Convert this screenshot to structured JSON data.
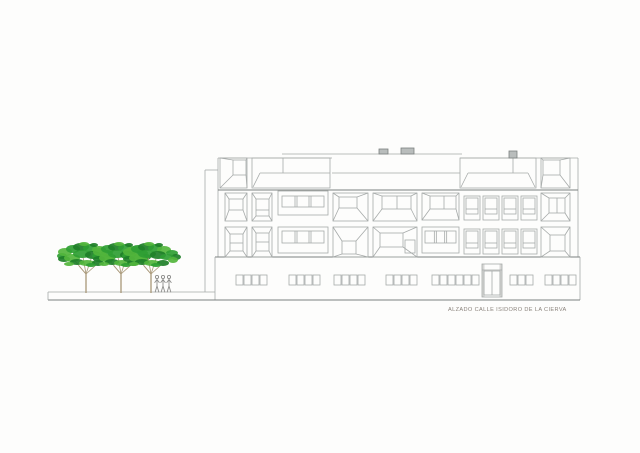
{
  "title_caption": "ALZADO CALLE ISIDORO DE LA CIERVA",
  "colors": {
    "background": "#fdfdfc",
    "line": "#a6aaa9",
    "line_dark": "#7c817f",
    "caption_text": "#8a827b",
    "vent_fill": "#b9bdbc",
    "jamb_fill": "#d8d8d6",
    "trunk": "#a89878",
    "person": "#8d8d8b",
    "greens": [
      "#2f9e33",
      "#53b53c",
      "#1e7f28"
    ]
  },
  "drawing": {
    "canvas": {
      "w": 640,
      "h": 453
    },
    "lines": [
      [
        218,
        158,
        218,
        257,
        "n"
      ],
      [
        578,
        158,
        578,
        257,
        "n"
      ],
      [
        218,
        158,
        332,
        158,
        "n"
      ],
      [
        460,
        158,
        578,
        158,
        "n"
      ],
      [
        218,
        190,
        578,
        190,
        "d"
      ],
      [
        215,
        257,
        580,
        257,
        "d"
      ],
      [
        215,
        257,
        215,
        300,
        "n"
      ],
      [
        580,
        257,
        580,
        300,
        "n"
      ],
      [
        48,
        300,
        580,
        300,
        "d"
      ],
      [
        48,
        292,
        215,
        292,
        "n"
      ],
      [
        48,
        292,
        48,
        300,
        "n"
      ],
      [
        205,
        170,
        205,
        292,
        "n"
      ],
      [
        205,
        170,
        218,
        170,
        "n"
      ],
      [
        282,
        154,
        462,
        154,
        "n"
      ],
      [
        332,
        173,
        460,
        173,
        "n"
      ],
      [
        260,
        173,
        330,
        173,
        "n"
      ],
      [
        283,
        158,
        283,
        173,
        "n"
      ],
      [
        253,
        187,
        260,
        173,
        "n"
      ],
      [
        468,
        173,
        528,
        173,
        "n"
      ],
      [
        461,
        187,
        468,
        173,
        "n"
      ],
      [
        535,
        187,
        528,
        173,
        "n"
      ],
      [
        513,
        158,
        513,
        173,
        "n"
      ],
      [
        405,
        148,
        405,
        154,
        "n"
      ],
      [
        409,
        148,
        409,
        154,
        "n"
      ]
    ],
    "rects": [
      [
        252,
        158,
        78,
        30,
        "n"
      ],
      [
        460,
        158,
        76,
        30,
        "n"
      ],
      [
        405,
        240,
        10,
        13,
        "n"
      ]
    ],
    "splay_panels": [
      {
        "r": [
          220,
          158,
          27,
          30
        ],
        "inner": [
          233,
          160,
          13,
          15
        ],
        "extra": []
      },
      {
        "r": [
          541,
          158,
          29,
          30
        ],
        "inner": [
          543,
          160,
          17,
          15
        ],
        "extra": []
      },
      {
        "r": [
          225,
          193,
          22,
          28
        ],
        "inner": [
          229,
          199,
          14,
          11
        ],
        "extra": []
      },
      {
        "r": [
          252,
          193,
          20,
          28
        ],
        "inner": [
          256,
          199,
          13,
          17
        ],
        "extra": [
          [
            256,
            210,
            269,
            210
          ]
        ]
      },
      {
        "r": [
          333,
          193,
          35,
          28
        ],
        "inner": [
          339,
          197,
          18,
          11
        ],
        "extra": []
      },
      {
        "r": [
          373,
          193,
          44,
          28
        ],
        "inner": [
          382,
          196,
          29,
          13
        ],
        "extra": [
          [
            397,
            196,
            397,
            209
          ]
        ]
      },
      {
        "r": [
          422,
          193,
          37,
          27
        ],
        "inner": [
          430,
          196,
          26,
          13
        ],
        "extra": [
          [
            444,
            196,
            444,
            209
          ]
        ]
      },
      {
        "r": [
          541,
          193,
          29,
          28
        ],
        "inner": [
          549,
          198,
          16,
          15
        ],
        "extra": [
          [
            557,
            198,
            557,
            213
          ]
        ]
      },
      {
        "r": [
          225,
          227,
          22,
          30
        ],
        "inner": [
          230,
          234,
          13,
          17
        ],
        "extra": [
          [
            230,
            243,
            243,
            243
          ]
        ]
      },
      {
        "r": [
          252,
          227,
          20,
          30
        ],
        "inner": [
          256,
          233,
          13,
          18
        ],
        "extra": [
          [
            256,
            242,
            269,
            242
          ]
        ]
      },
      {
        "r": [
          333,
          227,
          35,
          30
        ],
        "inner": [
          342,
          241,
          14,
          13
        ],
        "extra": []
      },
      {
        "r": [
          373,
          227,
          44,
          30
        ],
        "inner": [
          380,
          233,
          23,
          14
        ],
        "extra": []
      },
      {
        "r": [
          541,
          227,
          29,
          30
        ],
        "inner": [
          550,
          235,
          15,
          16
        ],
        "extra": []
      }
    ],
    "pane_panels": [
      {
        "r": [
          278,
          191,
          50,
          24
        ],
        "win": [
          282,
          196,
          42,
          11
        ],
        "n": 3
      },
      {
        "r": [
          278,
          227,
          50,
          26
        ],
        "win": [
          282,
          231,
          42,
          12
        ],
        "n": 3
      },
      {
        "r": [
          422,
          227,
          37,
          26
        ],
        "win": [
          425,
          231,
          31,
          12
        ],
        "n": 3
      }
    ],
    "square_windows": {
      "xs": [
        464,
        483,
        502,
        521
      ],
      "w": 16,
      "iw": 12,
      "rows": [
        {
          "y": 196,
          "h": 24,
          "iy": 198,
          "ih": 16,
          "ty": 209
        },
        {
          "y": 229,
          "h": 25,
          "iy": 231,
          "ih": 17,
          "ty": 243
        }
      ]
    },
    "ground_groups": {
      "y": 275,
      "pane_w": 7,
      "pane_h": 10,
      "step": 8,
      "items": [
        {
          "x": 236,
          "n": 4
        },
        {
          "x": 289,
          "n": 4
        },
        {
          "x": 334,
          "n": 4
        },
        {
          "x": 386,
          "n": 4
        },
        {
          "x": 432,
          "n": 6
        },
        {
          "x": 510,
          "n": 3
        },
        {
          "x": 545,
          "n": 4
        }
      ]
    },
    "door": {
      "frame": [
        482,
        264,
        20,
        33
      ],
      "transom_y": 270,
      "leaves": [
        484,
        271,
        16,
        24
      ],
      "split_x": 492,
      "jamb_w": 2.5
    },
    "vents": [
      [
        379,
        149,
        9,
        5
      ],
      [
        401,
        148,
        13,
        6
      ],
      [
        509,
        151,
        8,
        7
      ]
    ],
    "trees": {
      "xs": [
        86,
        121,
        151
      ],
      "base_y": 293,
      "fork_y": 274,
      "canopy_cy": 256,
      "branches": [
        [
          -11,
          -13
        ],
        [
          -3,
          -17
        ],
        [
          5,
          -15
        ],
        [
          10,
          -9
        ],
        [
          -7,
          -8
        ]
      ],
      "leaves": [
        [
          -24,
          0,
          5,
          3,
          0
        ],
        [
          -21,
          -4,
          7,
          4,
          1
        ],
        [
          -13,
          -7,
          7,
          4,
          0
        ],
        [
          -5,
          -9,
          8,
          4,
          2
        ],
        [
          4,
          -8,
          7,
          4,
          0
        ],
        [
          13,
          -6,
          7,
          4,
          1
        ],
        [
          21,
          -3,
          6,
          3,
          0
        ],
        [
          25,
          1,
          5,
          3,
          2
        ],
        [
          -22,
          3,
          6,
          3,
          2
        ],
        [
          -14,
          2,
          8,
          4,
          1
        ],
        [
          -4,
          -2,
          9,
          4,
          0
        ],
        [
          7,
          -1,
          8,
          4,
          2
        ],
        [
          16,
          1,
          7,
          3,
          0
        ],
        [
          22,
          4,
          5,
          3,
          1
        ],
        [
          -9,
          6,
          7,
          3,
          2
        ],
        [
          1,
          7,
          8,
          3,
          1
        ],
        [
          12,
          7,
          6,
          3,
          2
        ],
        [
          -17,
          8,
          5,
          2,
          1
        ],
        [
          5,
          9,
          5,
          2,
          0
        ],
        [
          -2,
          -12,
          5,
          2,
          1
        ],
        [
          8,
          -11,
          4,
          2,
          2
        ]
      ]
    },
    "people": {
      "xs": [
        157,
        163,
        169
      ],
      "base_y": 292
    },
    "caption_pos": {
      "x": 448,
      "y": 311
    }
  }
}
